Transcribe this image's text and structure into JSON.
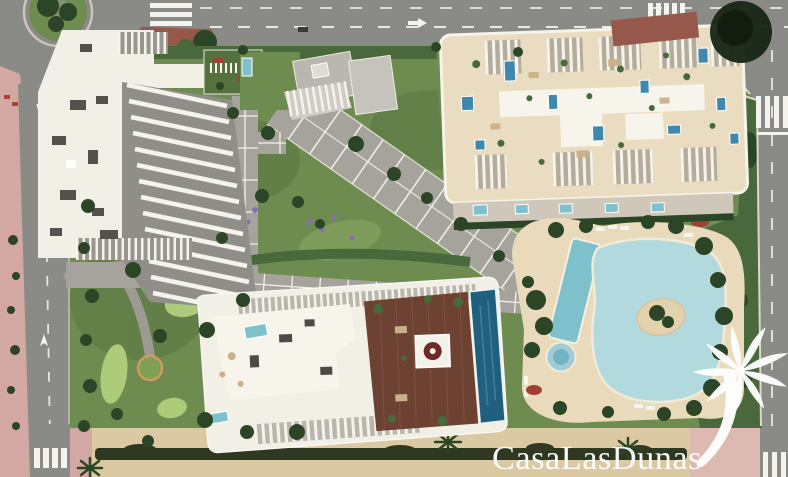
{
  "watermark": {
    "text": "CasaLasDunas",
    "logo_icon": "palm-tree-icon"
  },
  "palette": {
    "asphalt": "#8a8a86",
    "road_marking": "#f4f3ee",
    "sidewalk": "#b5b1a9",
    "pink_pavement": "#d3a8a2",
    "pink_pavement_light": "#dcb9b1",
    "sand": "#dbc9a3",
    "hedge_dark": "#2f3820",
    "grass": "#6f8c50",
    "grass_dark": "#54713e",
    "putting_green": "#aecb7c",
    "tree_dark": "#2c4526",
    "tree_mid": "#49693c",
    "building_white": "#f2efe6",
    "roof_slab_white": "#f7f4ec",
    "fin_shadow": "#8f8e88",
    "roof_gray": "#bab7b0",
    "terrace_beige": "#e9dcc0",
    "deck_beige": "#e8dabb",
    "pool_light": "#b2dade",
    "pool_mid": "#7fc0cd",
    "pool_blue": "#3f87ad",
    "pool_deep": "#205f7e",
    "deck_wood": "#6e4232",
    "red_roof": "#96584a",
    "flower_red": "#a03f33",
    "flower_purple": "#8a6fae",
    "island_sand": "#e2d2ae",
    "ac_unit_gray": "#53524e",
    "path_gray": "#a6a39d",
    "watermark_white": "#ffffff",
    "dark_tree_canopy": "#1c2817"
  }
}
